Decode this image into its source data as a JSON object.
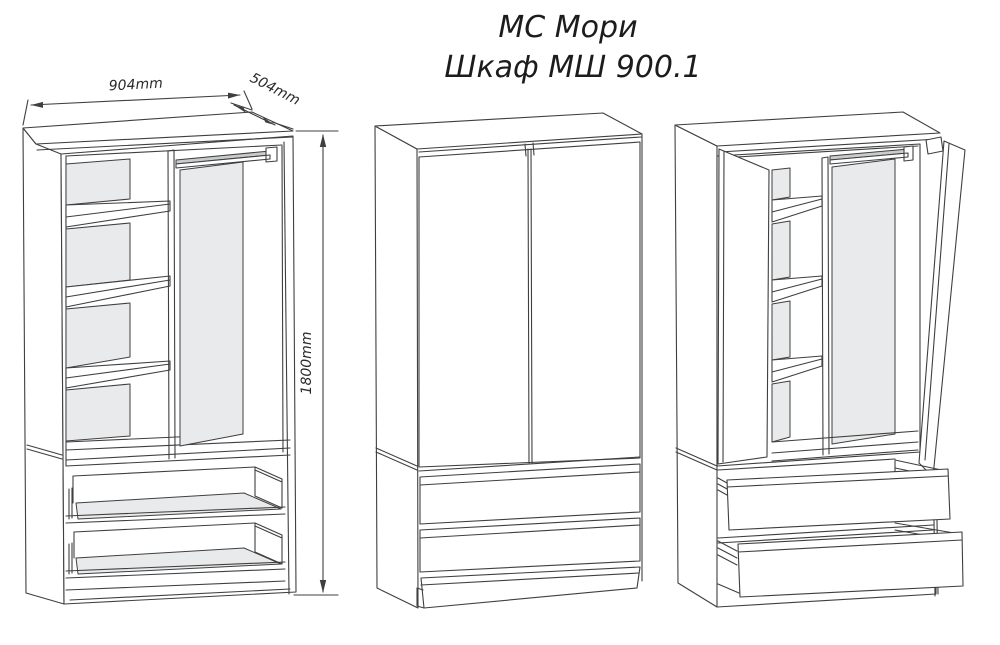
{
  "title": {
    "line1": "МС Мори",
    "line2": "Шкаф МШ 900.1"
  },
  "dimensions": {
    "width": "904mm",
    "depth": "504mm",
    "height": "1800mm"
  },
  "colors": {
    "ink": "#3f3f3f",
    "panel_shade": "#e9eaeb",
    "rail_shade": "#c9ccce",
    "background": "#ffffff"
  }
}
